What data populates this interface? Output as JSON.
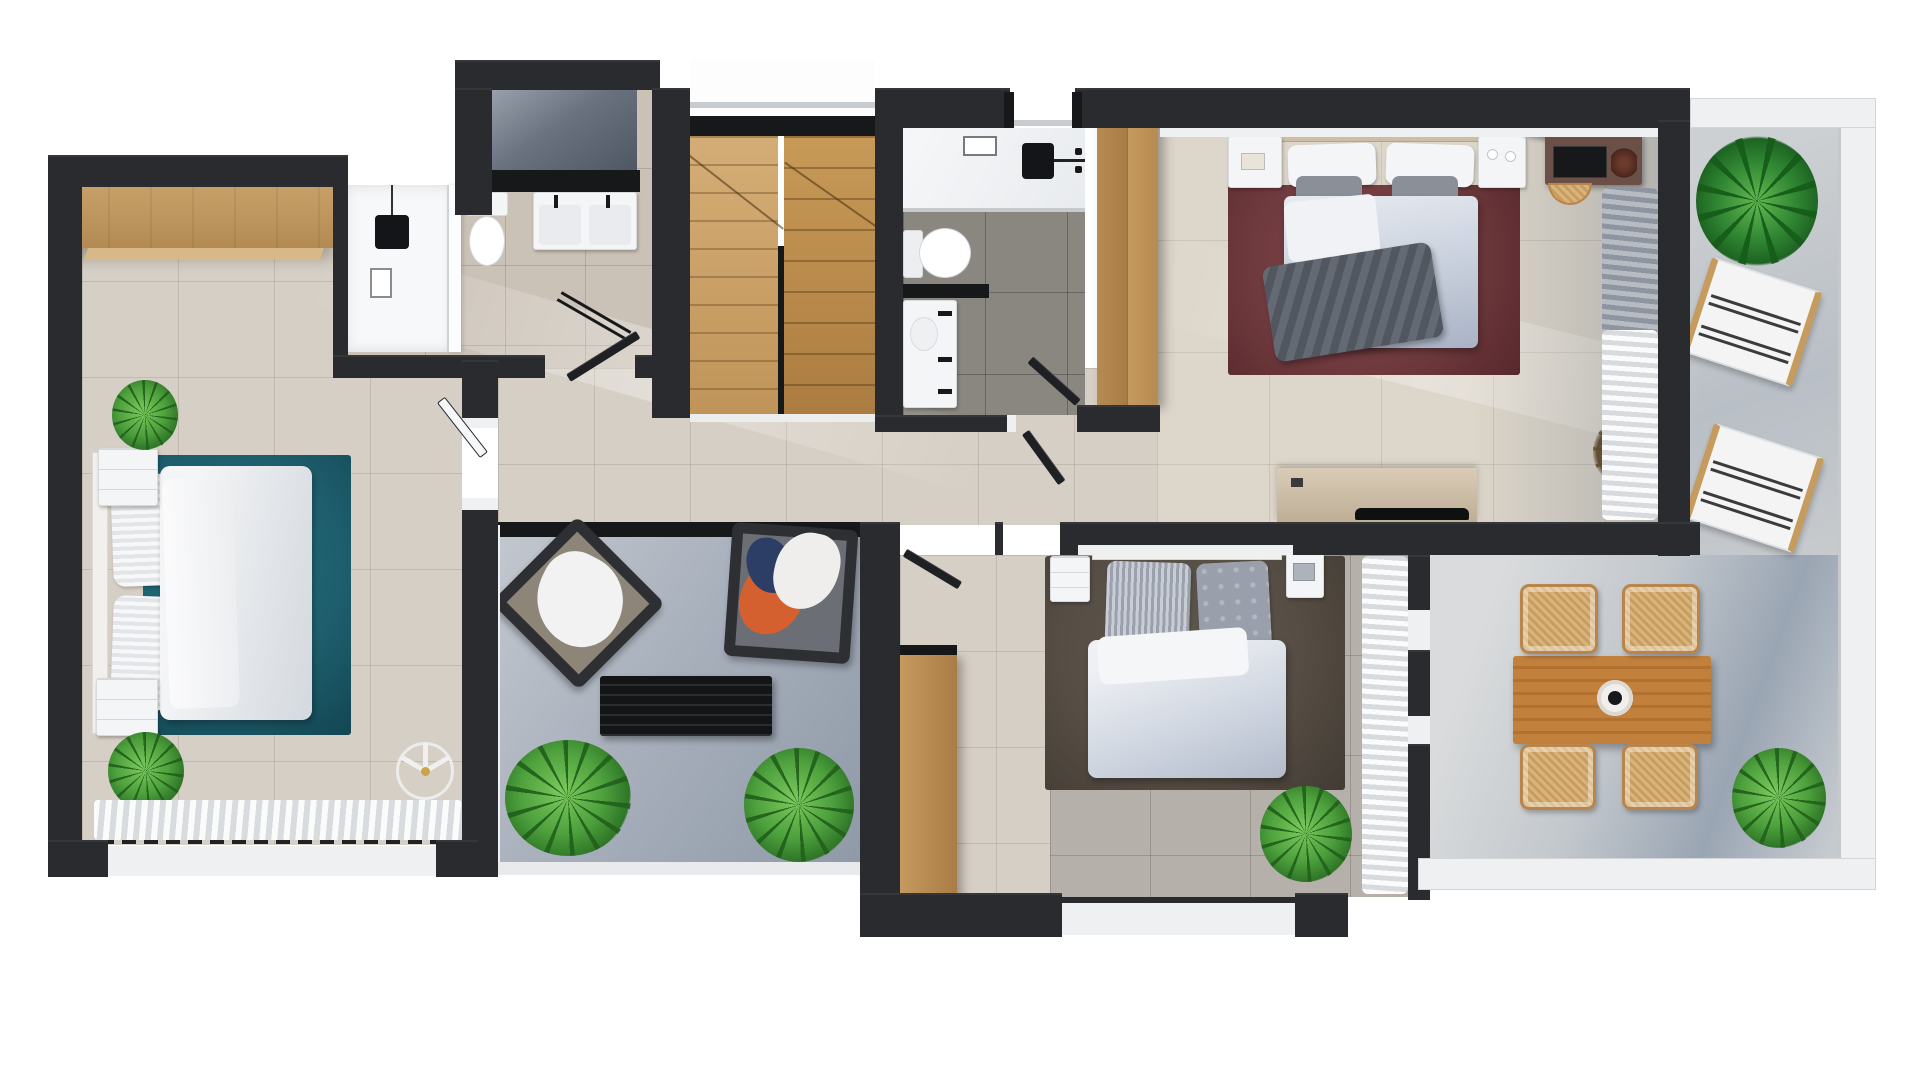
{
  "scene": {
    "title": "3D top-down floor plan render — apartment upper floor",
    "style": "photorealistic dollhouse view, dark charcoal walls on white background",
    "counts": {
      "bedrooms": 3,
      "bathrooms": 2,
      "terraces": 3,
      "staircases": 1
    }
  },
  "palette": {
    "background": "#ffffff",
    "wall": "#2a2b2e",
    "wall_black": "#17181a",
    "tile_greige": "#d6cfc5",
    "tile_master": "#ddd6ca",
    "tile_gray": "#b5b1aa",
    "bath_dark_tile": "#8a8680",
    "living_concrete": "#a8b0bc",
    "terrace_concrete": "#c3c8cd",
    "wood_light": "#c9a26a",
    "wood_cabinet": "#b98c52",
    "wood_stairs": "#c8a06a",
    "wood_dining": "#c2803d",
    "rug_teal": "#1e5e6d",
    "rug_maroon": "#6f3a3e",
    "rug_taupe": "#564e45",
    "linen_white": "#f2f2f4",
    "duvet_blue_gray": "#c2c9d8",
    "throw_gray": "#5a5f68",
    "shower_slate": "#5e6673",
    "plant_green": "#4f9e3f",
    "rattan": "#d2a86f"
  },
  "rooms": {
    "bedroom_1": {
      "name": "Bedroom 1 (left)",
      "furniture": [
        "double bed with white duvet",
        "teal rug",
        "wardrobe",
        "2 white nightstands",
        "ceiling fan",
        "2 green plants",
        "curtained picture window"
      ]
    },
    "bathroom_1": {
      "name": "Bathroom 1 with utility shower",
      "furniture": [
        "slate shower tray",
        "walk-in shower",
        "toilet",
        "double washbasin",
        "towel rail",
        "door"
      ]
    },
    "staircase": {
      "name": "Staircase",
      "furniture": [
        "two wooden winder flights",
        "central stringer",
        "glass balustrade"
      ]
    },
    "bathroom_2": {
      "name": "Bathroom 2",
      "furniture": [
        "walk-in shower",
        "toilet",
        "vanity basin",
        "black shelf",
        "door"
      ]
    },
    "hall_wardrobe": {
      "name": "Hallway wardrobe",
      "furniture": [
        "tall oak cabinet"
      ]
    },
    "master_bedroom": {
      "name": "Master Bedroom",
      "furniture": [
        "king bed with gray throw",
        "maroon rug",
        "2 nightstands with pendant lamps",
        "round-mirror vanity with stool",
        "TV sideboard",
        "dried grass plant",
        "gray and white curtains"
      ]
    },
    "hallway": {
      "name": "Hallway",
      "furniture": [
        "open doors to bathrooms and bedrooms"
      ]
    },
    "living_terrace": {
      "name": "Lounge patio",
      "furniture": [
        "2 black-frame armchairs with blankets",
        "black slatted coffee table",
        "2 green plants"
      ]
    },
    "bedroom_2": {
      "name": "Bedroom 2 (lower)",
      "furniture": [
        "double bed",
        "taupe rug",
        "2 nightstands",
        "oak wardrobe",
        "green plant",
        "white curtain wall"
      ]
    },
    "dining_terrace": {
      "name": "Dining terrace",
      "furniture": [
        "teak dining table with vase",
        "4 rattan chairs",
        "green plant"
      ]
    },
    "balcony": {
      "name": "Balcony terrace",
      "furniture": [
        "palm plant",
        "2 striped sun loungers",
        "glass parapet"
      ]
    }
  }
}
